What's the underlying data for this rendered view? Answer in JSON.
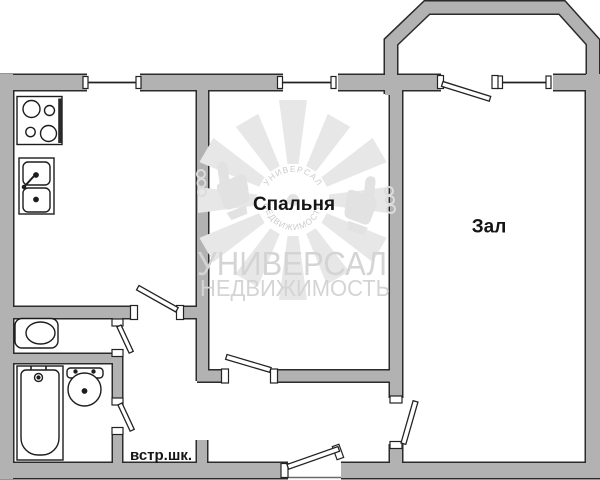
{
  "floorplan": {
    "rooms": {
      "bedroom_label": "Спальня",
      "hall_label": "Зал",
      "closet_label": "встр.шк."
    },
    "watermark": {
      "brand_line1": "УНИВЕРСАЛ",
      "brand_line2": "НЕДВИЖИМОСТЬ",
      "logo_arc_top": "УНИВЕРСАЛ",
      "logo_arc_bottom": "НЕДВИЖИМОСТЬ"
    },
    "fixtures": [
      "stove",
      "kitchen-sink",
      "toilet",
      "bathtub",
      "washbasin"
    ],
    "colors": {
      "background": "#ffffff",
      "wall_fill": "#b2b2b2",
      "wall_outline": "#2b2b2b",
      "fixture_line": "#1d1d1d",
      "label_text": "#151515",
      "watermark_shape": "#e7e7e7",
      "watermark_text": "#d4d4d4"
    }
  }
}
